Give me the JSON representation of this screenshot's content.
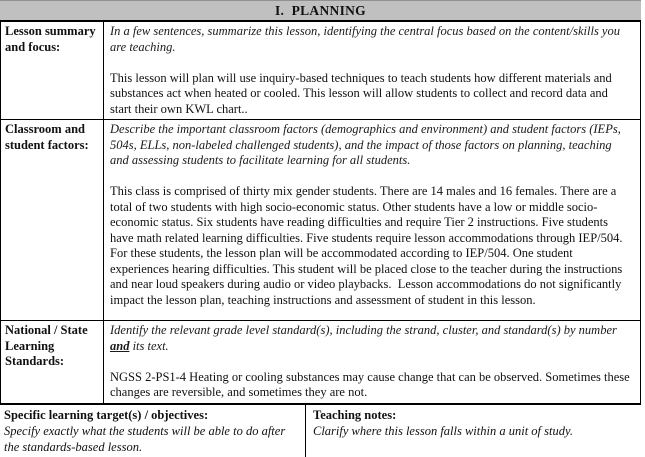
{
  "header": {
    "title": "I.  PLANNING",
    "background_color": "#c0c0c0",
    "border_color": "#000000"
  },
  "rows": [
    {
      "label": "Lesson summary and focus:",
      "prompt": "In a few sentences, summarize this lesson, identifying the central focus based on the content/skills you are teaching.",
      "content": "This lesson will plan will use inquiry-based techniques to teach students how different materials and substances act when heated or cooled. This lesson will allow students to collect and record data and start their own KWL chart.."
    },
    {
      "label": "Classroom and student factors:",
      "prompt": "Describe the important classroom factors (demographics and environment) and student factors (IEPs, 504s, ELLs, non-labeled challenged students), and the impact of those factors on planning, teaching and assessing students to facilitate learning for all students.",
      "content": "This class is comprised of thirty mix gender students. There are 14 males and 16 females. There are a total of two students with high socio-economic status. Other students have a low or middle socio-economic status. Six students have reading difficulties and require Tier 2 instructions. Five students have math related learning difficulties. Five students require lesson accommodations through IEP/504. For these students, the lesson plan will be accommodated according to IEP/504. One student experiences hearing difficulties. This student will be placed close to the teacher during the instructions and near loud speakers during audio or video playbacks.  Lesson accommodations do not significantly impact the lesson plan, teaching instructions and assessment of student in this lesson."
    },
    {
      "label": "National / State Learning Standards:",
      "prompt_before": "Identify the relevant grade level standard(s), including the strand, cluster, and standard(s) by number ",
      "prompt_emph": "and",
      "prompt_after": " its text.",
      "content": "NGSS 2-PS1-4 Heating or cooling substances may cause change that can be observed. Sometimes these changes are reversible, and sometimes they are not."
    }
  ],
  "bottom": {
    "left": {
      "heading": "Specific learning target(s) / objectives:",
      "prompt": "Specify exactly what the students will be able to do after the standards-based lesson."
    },
    "right": {
      "heading": "Teaching notes:",
      "prompt": "Clarify where this lesson falls within a unit of study."
    }
  }
}
